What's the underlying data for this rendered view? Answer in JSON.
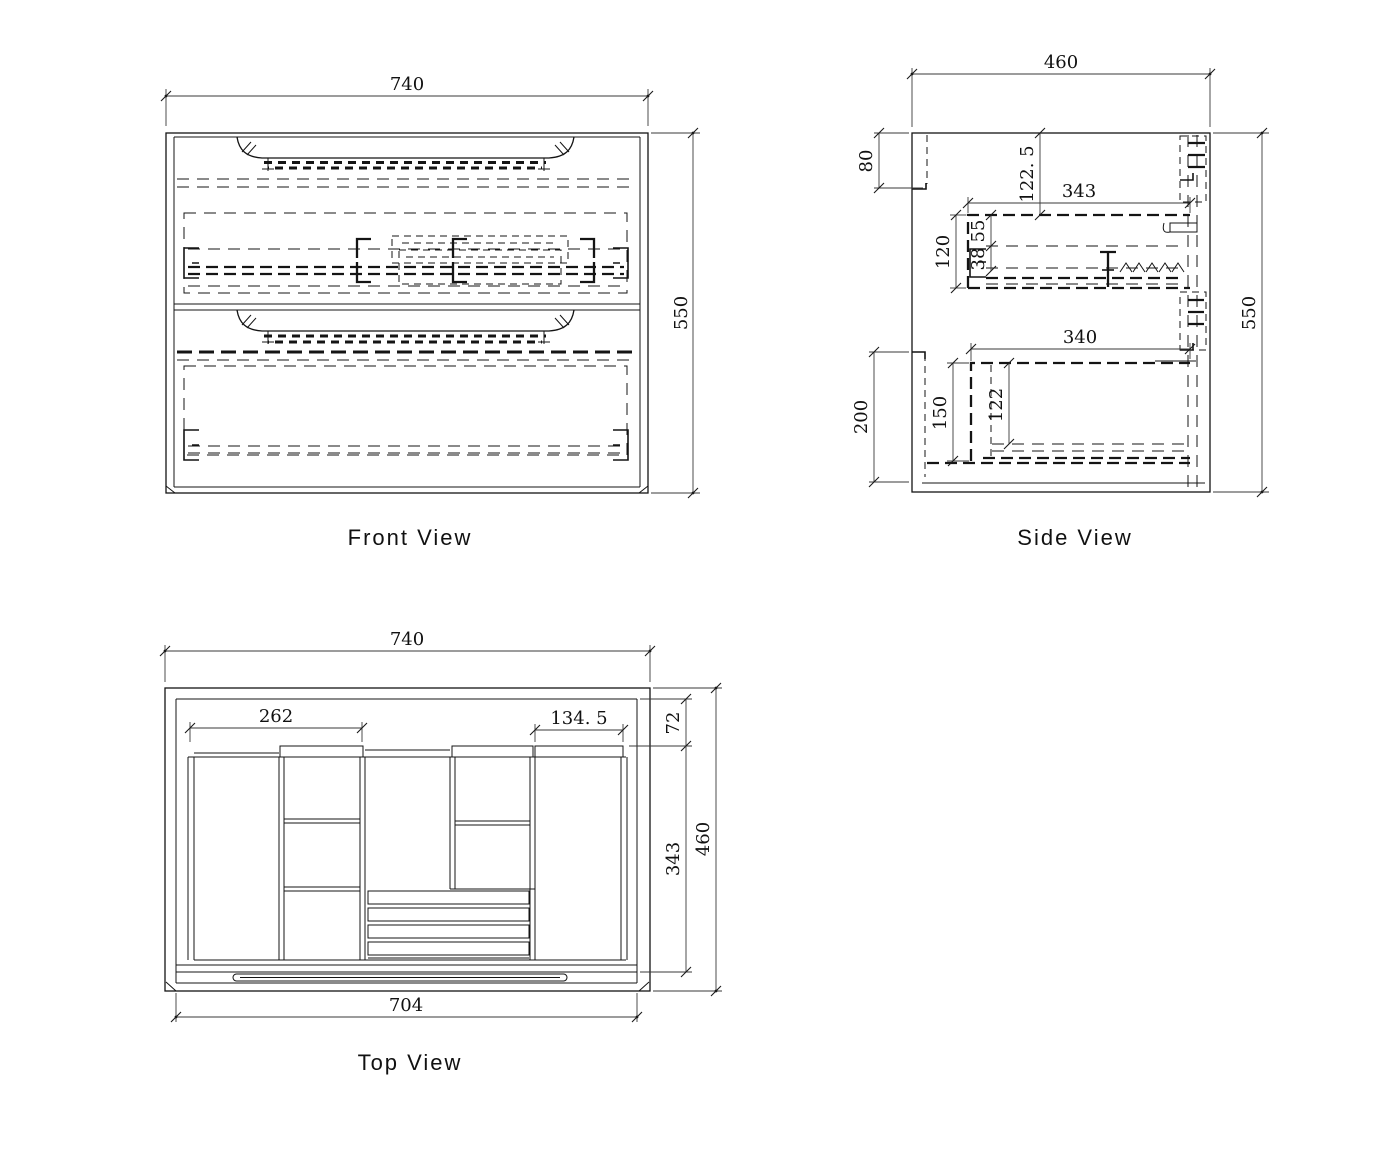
{
  "front": {
    "title": "Front View",
    "width": "740",
    "height": "550"
  },
  "side": {
    "title": "Side View",
    "width": "460",
    "height": "550",
    "top_bracket": "80",
    "bottom_bracket": "200",
    "top_inset": "122. 5",
    "upper_depth": "343",
    "upper_height": "120",
    "upper_seg1": "55",
    "upper_seg2": "38",
    "lower_depth": "340",
    "lower_height": "150",
    "lower_inner": "122"
  },
  "top": {
    "title": "Top View",
    "width": "740",
    "inner_width": "704",
    "depth": "460",
    "back_band": "72",
    "inner_depth": "343",
    "left_span": "262",
    "right_span": "134. 5"
  }
}
